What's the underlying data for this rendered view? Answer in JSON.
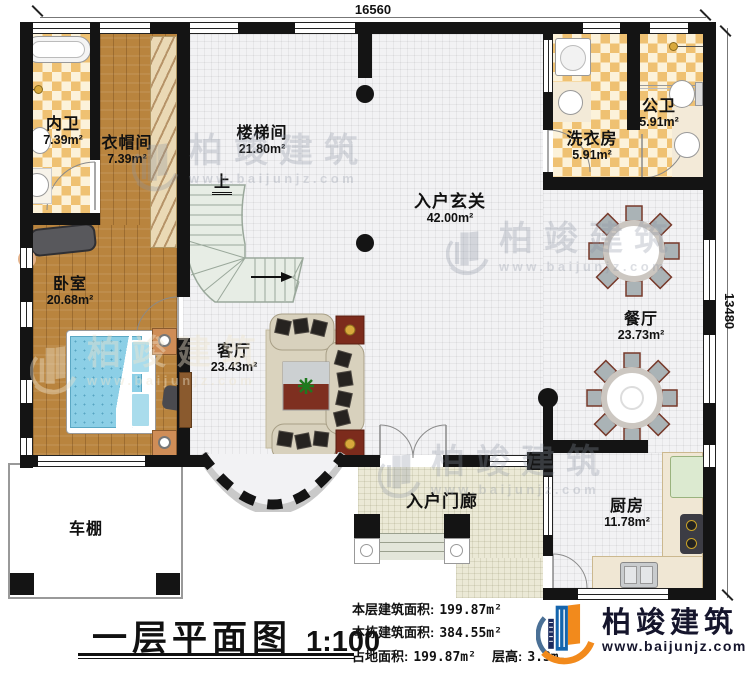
{
  "dimensions": {
    "top": "16560",
    "right": "13480"
  },
  "rooms": [
    {
      "name": "内卫",
      "area": "7.39m²"
    },
    {
      "name": "衣帽间",
      "area": "7.39m²"
    },
    {
      "name": "楼梯间",
      "area": "21.80m²"
    },
    {
      "name": "入户玄关",
      "area": "42.00m²"
    },
    {
      "name": "洗衣房",
      "area": "5.91m²"
    },
    {
      "name": "公卫",
      "area": "5.91m²"
    },
    {
      "name": "卧室",
      "area": "20.68m²"
    },
    {
      "name": "餐厅",
      "area": "23.73m²"
    },
    {
      "name": "客厅",
      "area": "23.43m²"
    },
    {
      "name": "入户门廊",
      "area": ""
    },
    {
      "name": "厨房",
      "area": "11.78m²"
    },
    {
      "name": "车棚",
      "area": ""
    }
  ],
  "stair": {
    "up_label": "上"
  },
  "title_block": {
    "title": "一层平面图",
    "scale": "1:100"
  },
  "stats": {
    "line1_label": "本层建筑面积:",
    "line1_value": "199.87m²",
    "line2_label": "本栋建筑面积:",
    "line2_value": "384.55m²",
    "line3a_label": "占地面积:",
    "line3a_value": "199.87m²",
    "line3b_label": "层高:",
    "line3b_value": "3.3m"
  },
  "logo": {
    "name": "柏竣建筑",
    "url": "www.baijunjz.com"
  },
  "watermark": {
    "name": "柏竣建筑",
    "url": "www.baijunjz.com"
  },
  "colors": {
    "wall": "#141414",
    "checker_tile": "#efc172",
    "wood_floor": "#b9843e",
    "logo_blue": "#1565ad",
    "logo_orange": "#f28a1c",
    "logo_navy": "#1b2a5e",
    "bed_blue": "#8ccfe6",
    "accent_red_table": "#7e2f20"
  }
}
